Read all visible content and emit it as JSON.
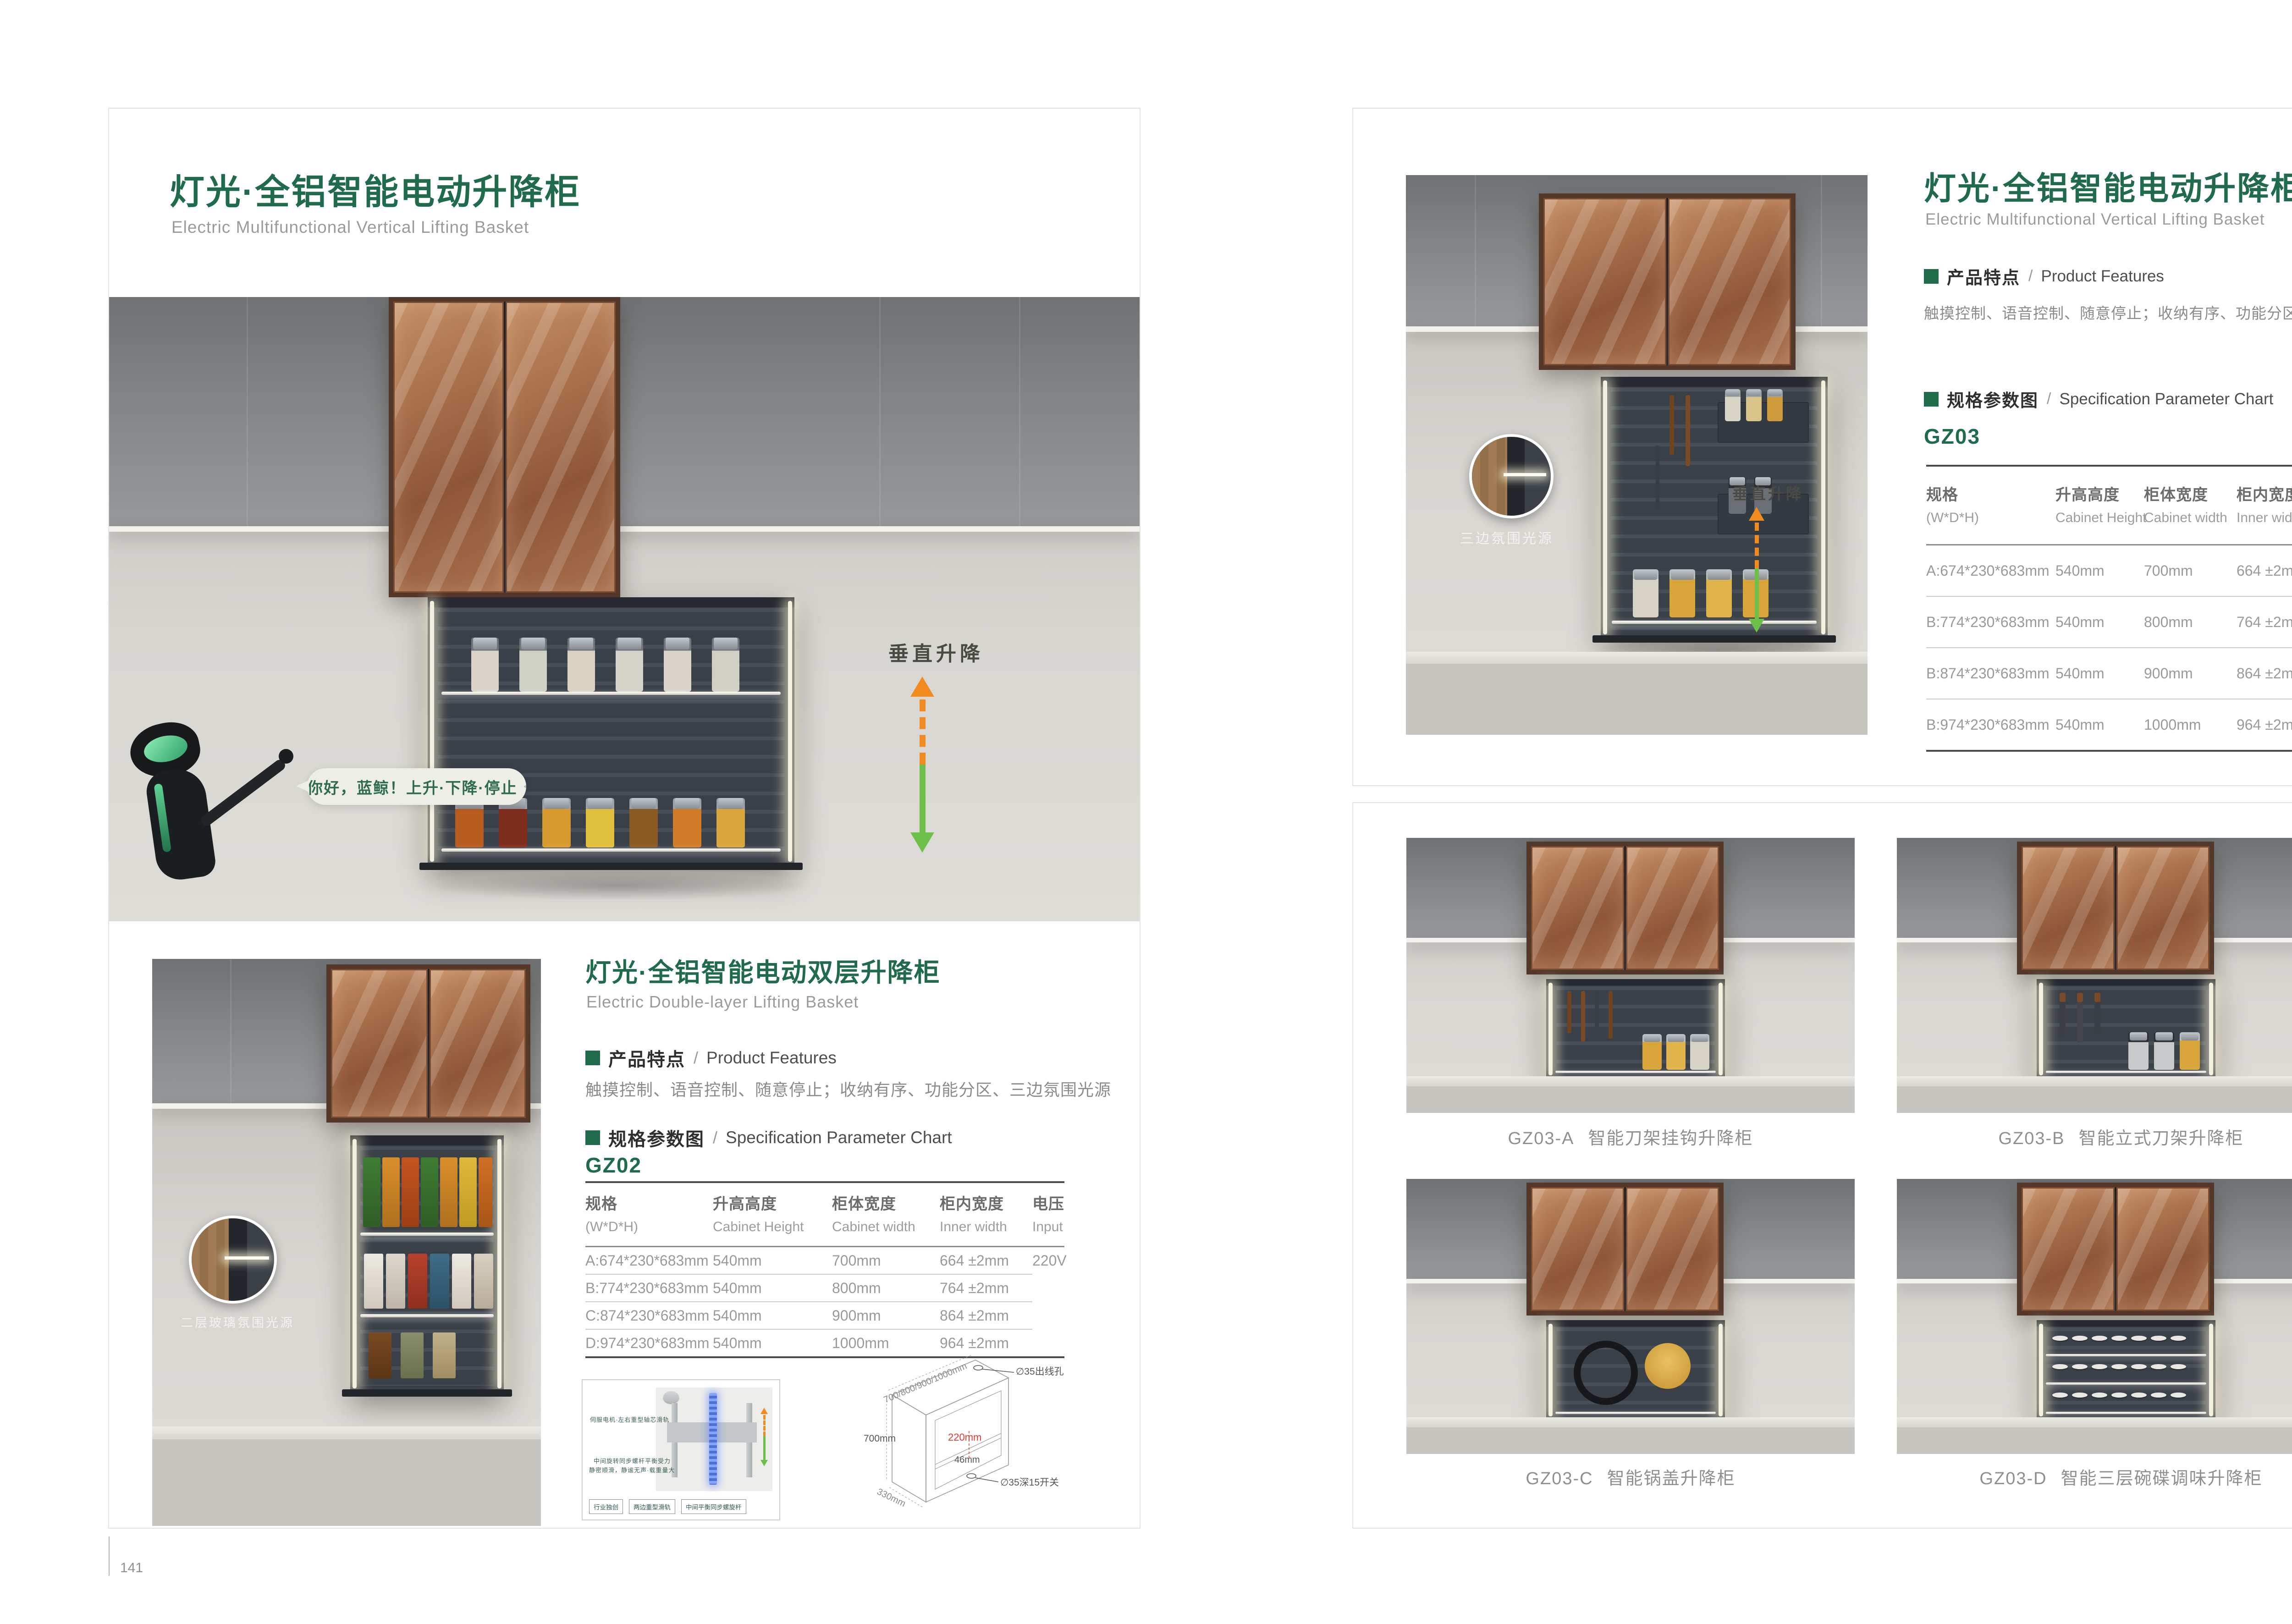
{
  "brand": {
    "accent_green": "#1f6b4c",
    "arrow_orange": "#f28b1f",
    "arrow_green": "#6cc049",
    "dim_red": "#e23b2e"
  },
  "spec_headers": [
    {
      "zh": "规格",
      "en": "(W*D*H)"
    },
    {
      "zh": "升高高度",
      "en": "Cabinet Height"
    },
    {
      "zh": "柜体宽度",
      "en": "Cabinet width"
    },
    {
      "zh": "柜内宽度",
      "en": "Inner width"
    },
    {
      "zh": "电压",
      "en": "Input"
    }
  ],
  "left_page": {
    "page_number": "141",
    "title": "灯光·全铝智能电动升降柜",
    "subtitle": "Electric Multifunctional Vertical Lifting Basket",
    "hero": {
      "bubble_text": "你好，蓝鲸！上升·下降·停止",
      "lift_label": "垂直升降"
    },
    "section": {
      "title": "灯光·全铝智能电动双层升降柜",
      "subtitle": "Electric Double-layer Lifting Basket",
      "features_zh": "产品特点",
      "slash": "/",
      "features_en": "Product Features",
      "features_text": "触摸控制、语音控制、随意停止；收纳有序、功能分区、三边氛围光源",
      "spec_zh": "规格参数图",
      "spec_en": "Specification Parameter Chart",
      "model": "GZ02",
      "photo_callout": "二层玻璃氛围光源",
      "rows": [
        [
          "A:674*230*683mm",
          "540mm",
          "700mm",
          "664 ±2mm",
          "220V"
        ],
        [
          "B:774*230*683mm",
          "540mm",
          "800mm",
          "764 ±2mm",
          ""
        ],
        [
          "C:874*230*683mm",
          "540mm",
          "900mm",
          "864 ±2mm",
          ""
        ],
        [
          "D:974*230*683mm",
          "540mm",
          "1000mm",
          "964 ±2mm",
          ""
        ]
      ]
    },
    "mechanism": {
      "note1": "伺服电机·左右重型轴芯滑轨",
      "note2a": "中间旋转同步螺杆平衡受力",
      "note2b": "静密顺滑，静谧无声·载重量大",
      "tags": [
        "行业独创",
        "两边重型滑轨",
        "中间平衡同步螺旋杆"
      ]
    },
    "dimensions": {
      "width_range": "700/800/900/1000mm",
      "top_hole": "∅35出线孔",
      "height": "700mm",
      "inner": "220mm",
      "offset": "46mm",
      "switch_hole": "∅35深15开关",
      "depth": "330mm"
    }
  },
  "right_page": {
    "page_number": "142",
    "title": "灯光·全铝智能电动升降柜",
    "subtitle": "Electric Multifunctional Vertical Lifting Basket",
    "features_zh": "产品特点",
    "slash": "/",
    "features_en": "Product Features",
    "features_text": "触摸控制、语音控制、随意停止；收纳有序、功能分区、三边氛围光源",
    "spec_zh": "规格参数图",
    "spec_en": "Specification Parameter Chart",
    "model": "GZ03",
    "hero_callout": "三边氛围光源",
    "lift_label": "垂直升降",
    "rows": [
      [
        "A:674*230*683mm",
        "540mm",
        "700mm",
        "664 ±2mm",
        "220V"
      ],
      [
        "B:774*230*683mm",
        "540mm",
        "800mm",
        "764 ±2mm",
        ""
      ],
      [
        "B:874*230*683mm",
        "540mm",
        "900mm",
        "864 ±2mm",
        ""
      ],
      [
        "B:974*230*683mm",
        "540mm",
        "1000mm",
        "964 ±2mm",
        ""
      ]
    ],
    "products": [
      {
        "code": "GZ03-A",
        "name": "智能刀架挂钩升降柜"
      },
      {
        "code": "GZ03-B",
        "name": "智能立式刀架升降柜"
      },
      {
        "code": "GZ03-C",
        "name": "智能锅盖升降柜"
      },
      {
        "code": "GZ03-D",
        "name": "智能三层碗碟调味升降柜"
      }
    ]
  }
}
